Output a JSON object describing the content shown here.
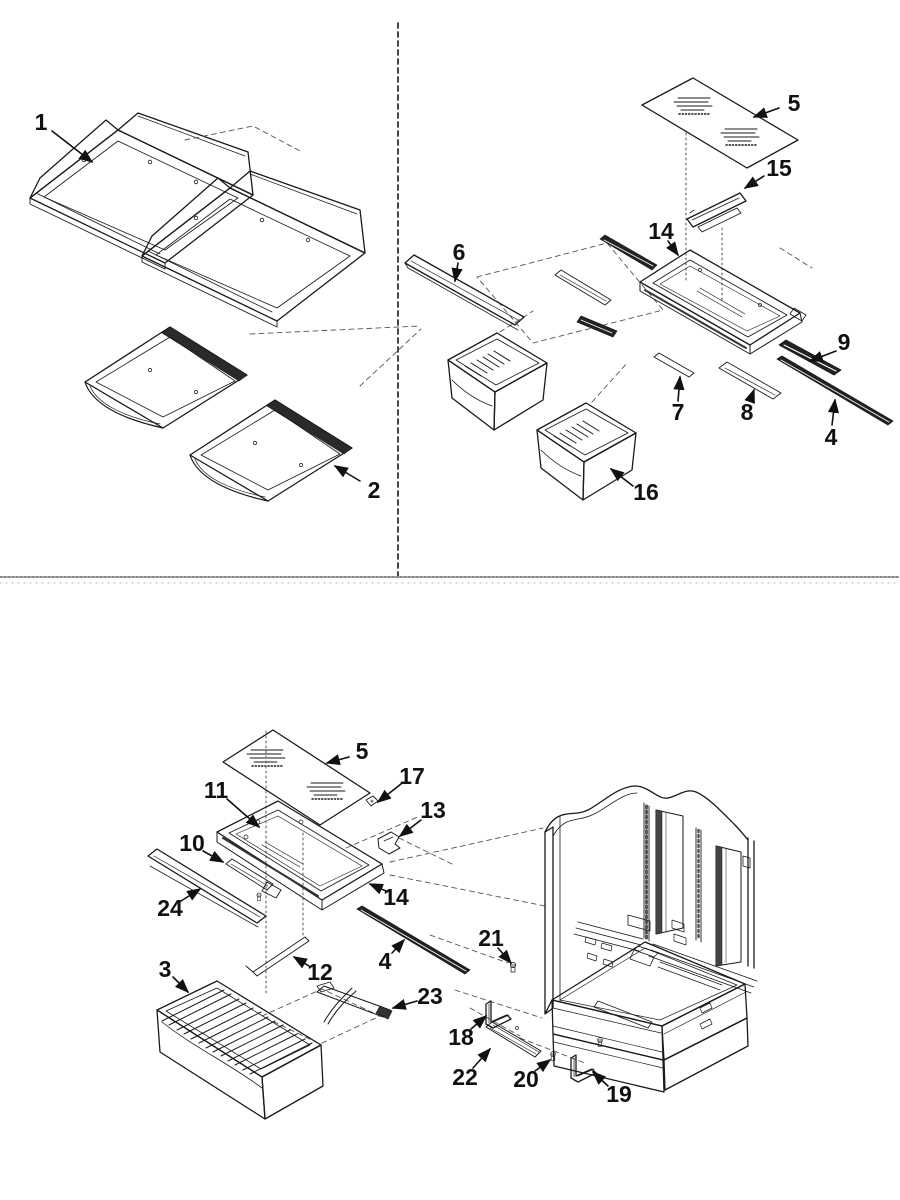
{
  "figure": {
    "kind": "exploded-parts-diagram",
    "subject": "refrigerator shelving, crisper bins, deli shelf and cabinet interior",
    "line_color": "#1a1a1a",
    "background": "#ffffff"
  },
  "callouts": [
    {
      "number": "1",
      "x": 41,
      "y": 130
    },
    {
      "number": "2",
      "x": 374,
      "y": 498
    },
    {
      "number": "5",
      "x": 794,
      "y": 111
    },
    {
      "number": "15",
      "x": 779,
      "y": 176
    },
    {
      "number": "14",
      "x": 661,
      "y": 239
    },
    {
      "number": "6",
      "x": 459,
      "y": 260
    },
    {
      "number": "9",
      "x": 844,
      "y": 350
    },
    {
      "number": "7",
      "x": 678,
      "y": 420
    },
    {
      "number": "8",
      "x": 747,
      "y": 420
    },
    {
      "number": "4",
      "x": 831,
      "y": 445
    },
    {
      "number": "16",
      "x": 646,
      "y": 500
    },
    {
      "number": "5",
      "x": 362,
      "y": 759
    },
    {
      "number": "17",
      "x": 412,
      "y": 784
    },
    {
      "number": "11",
      "x": 216,
      "y": 798
    },
    {
      "number": "13",
      "x": 433,
      "y": 818
    },
    {
      "number": "10",
      "x": 192,
      "y": 851
    },
    {
      "number": "24",
      "x": 170,
      "y": 916
    },
    {
      "number": "14",
      "x": 396,
      "y": 905
    },
    {
      "number": "4",
      "x": 385,
      "y": 969
    },
    {
      "number": "12",
      "x": 320,
      "y": 980
    },
    {
      "number": "21",
      "x": 491,
      "y": 946
    },
    {
      "number": "3",
      "x": 165,
      "y": 977
    },
    {
      "number": "23",
      "x": 430,
      "y": 1004
    },
    {
      "number": "18",
      "x": 461,
      "y": 1045
    },
    {
      "number": "22",
      "x": 465,
      "y": 1085
    },
    {
      "number": "20",
      "x": 526,
      "y": 1087
    },
    {
      "number": "19",
      "x": 619,
      "y": 1102
    }
  ]
}
